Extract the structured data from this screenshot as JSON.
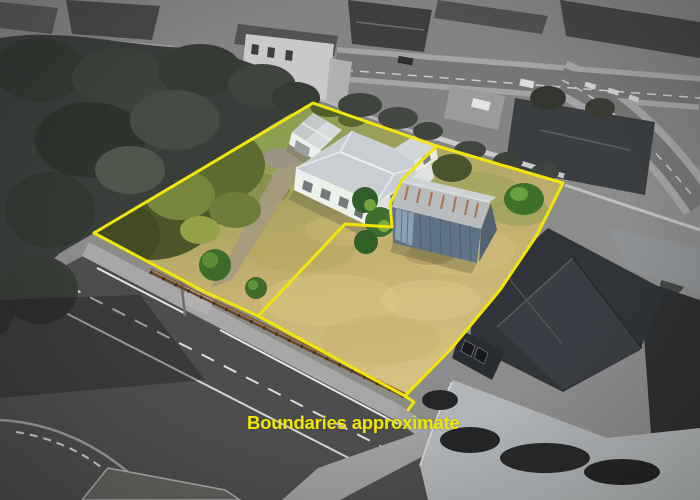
{
  "caption": {
    "text": "Boundaries approximate"
  },
  "colors": {
    "boundary": "#f2e50a",
    "caption": "#f0e40a",
    "road": "#4d4d4d",
    "footpath": "#a7a7a7",
    "house_wall": "#eef0ec",
    "house_roof": "#c9ced2",
    "shed_wall": "#5f7386",
    "shed_roof": "#b9bcbe",
    "rust": "#a8663a",
    "fence": "#6b4423",
    "neighbor_roof": "#303439",
    "neighbor_drive": "#b2b5b7"
  }
}
